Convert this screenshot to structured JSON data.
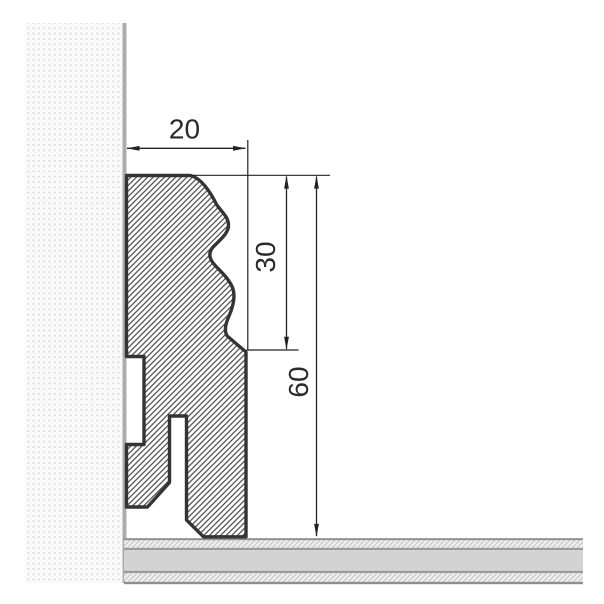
{
  "drawing": {
    "dimension_labels": {
      "width": "20",
      "molding_height": "30",
      "total_height": "60"
    },
    "colors": {
      "background": "#ffffff",
      "profile_outline": "#343434",
      "profile_hatch_line": "#404040",
      "dimension": "#222222",
      "label_text": "#2a2a2a",
      "wall_dot": "#d8d8d8",
      "wall_surface": "#ababab",
      "floor_core": "#d3d3d3",
      "floor_border": "#8e8e8e",
      "floor_separator": "#9a9a9a",
      "floor_underlay_bg": "#f0f0f0",
      "floor_underlay_hatch": "#c6c6c6"
    }
  }
}
